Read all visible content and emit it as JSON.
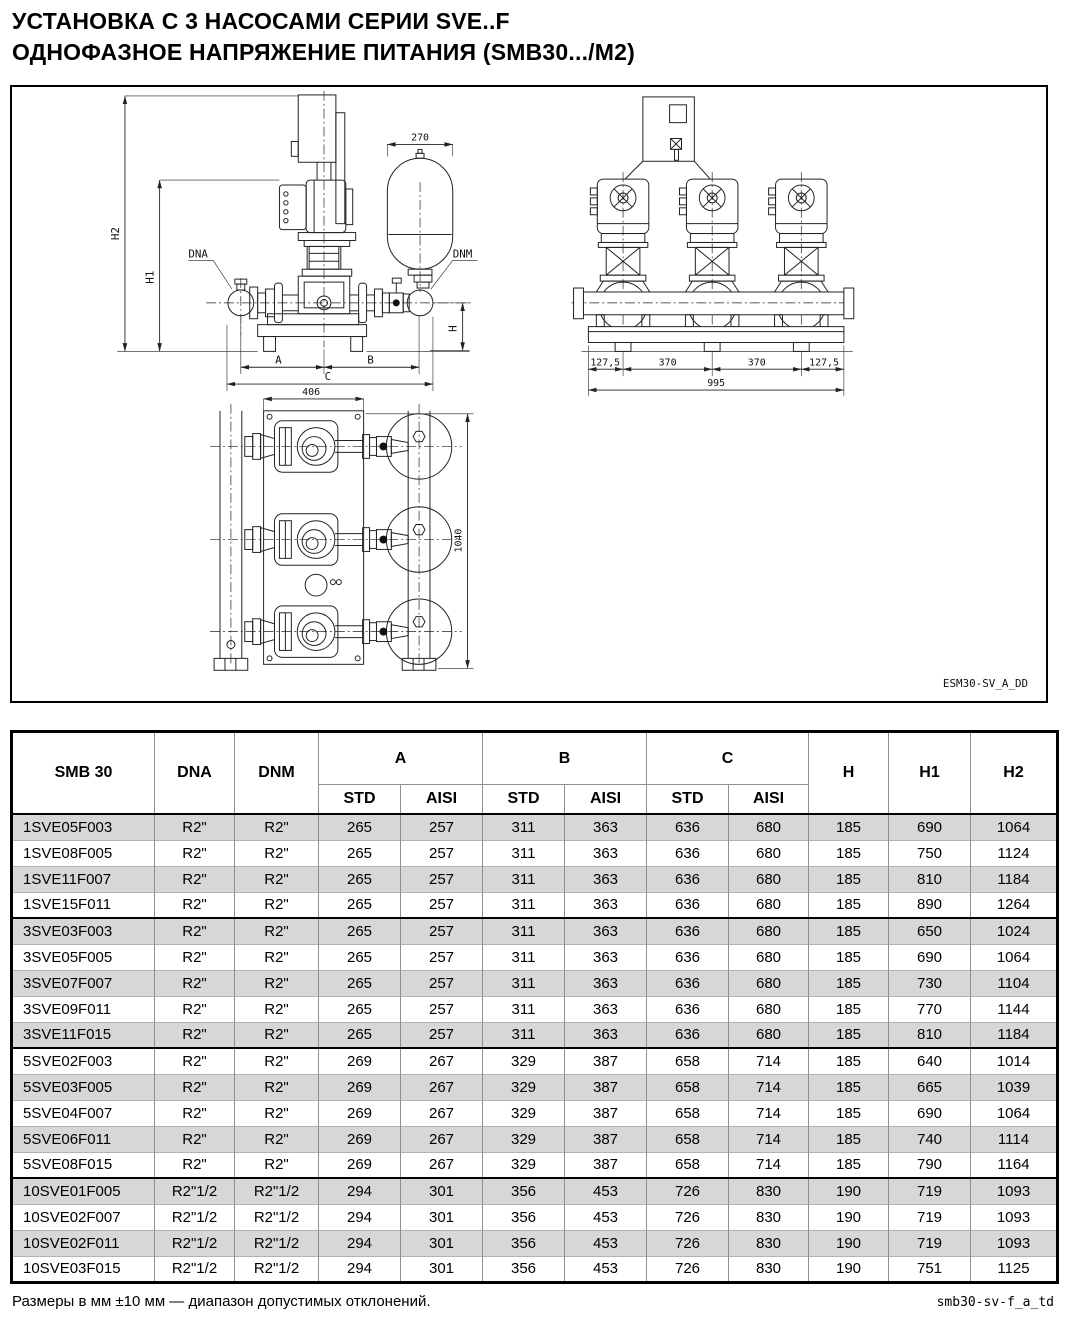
{
  "title": {
    "line1": "УСТАНОВКА С 3 НАСОСАМИ СЕРИИ SVE..F",
    "line2": "ОДНОФАЗНОЕ НАПРЯЖЕНИЕ ПИТАНИЯ (SMB30.../M2)"
  },
  "drawing": {
    "code": "ESM30-SV_A_DD",
    "front_view": {
      "h2": "H2",
      "h1": "H1",
      "h": "H",
      "dna": "DNA",
      "dnm": "DNM",
      "tank_width": "270",
      "a": "A",
      "b": "B",
      "c": "C"
    },
    "plan_view": {
      "width": "406",
      "depth": "1040"
    },
    "side_view": {
      "edge_left": "127,5",
      "pitch1": "370",
      "pitch2": "370",
      "edge_right": "127,5",
      "total": "995"
    }
  },
  "table": {
    "header": {
      "model": "SMB 30",
      "dna": "DNA",
      "dnm": "DNM",
      "a": "A",
      "b": "B",
      "c": "C",
      "std1": "STD",
      "aisi1": "AISI",
      "std2": "STD",
      "aisi2": "AISI",
      "std3": "STD",
      "aisi3": "AISI",
      "h": "H",
      "h1": "H1",
      "h2": "H2"
    },
    "groups": [
      {
        "rows": [
          [
            "1SVE05F003",
            "R2\"",
            "R2\"",
            "265",
            "257",
            "311",
            "363",
            "636",
            "680",
            "185",
            "690",
            "1064"
          ],
          [
            "1SVE08F005",
            "R2\"",
            "R2\"",
            "265",
            "257",
            "311",
            "363",
            "636",
            "680",
            "185",
            "750",
            "1124"
          ],
          [
            "1SVE11F007",
            "R2\"",
            "R2\"",
            "265",
            "257",
            "311",
            "363",
            "636",
            "680",
            "185",
            "810",
            "1184"
          ],
          [
            "1SVE15F011",
            "R2\"",
            "R2\"",
            "265",
            "257",
            "311",
            "363",
            "636",
            "680",
            "185",
            "890",
            "1264"
          ]
        ]
      },
      {
        "rows": [
          [
            "3SVE03F003",
            "R2\"",
            "R2\"",
            "265",
            "257",
            "311",
            "363",
            "636",
            "680",
            "185",
            "650",
            "1024"
          ],
          [
            "3SVE05F005",
            "R2\"",
            "R2\"",
            "265",
            "257",
            "311",
            "363",
            "636",
            "680",
            "185",
            "690",
            "1064"
          ],
          [
            "3SVE07F007",
            "R2\"",
            "R2\"",
            "265",
            "257",
            "311",
            "363",
            "636",
            "680",
            "185",
            "730",
            "1104"
          ],
          [
            "3SVE09F011",
            "R2\"",
            "R2\"",
            "265",
            "257",
            "311",
            "363",
            "636",
            "680",
            "185",
            "770",
            "1144"
          ],
          [
            "3SVE11F015",
            "R2\"",
            "R2\"",
            "265",
            "257",
            "311",
            "363",
            "636",
            "680",
            "185",
            "810",
            "1184"
          ]
        ]
      },
      {
        "rows": [
          [
            "5SVE02F003",
            "R2\"",
            "R2\"",
            "269",
            "267",
            "329",
            "387",
            "658",
            "714",
            "185",
            "640",
            "1014"
          ],
          [
            "5SVE03F005",
            "R2\"",
            "R2\"",
            "269",
            "267",
            "329",
            "387",
            "658",
            "714",
            "185",
            "665",
            "1039"
          ],
          [
            "5SVE04F007",
            "R2\"",
            "R2\"",
            "269",
            "267",
            "329",
            "387",
            "658",
            "714",
            "185",
            "690",
            "1064"
          ],
          [
            "5SVE06F011",
            "R2\"",
            "R2\"",
            "269",
            "267",
            "329",
            "387",
            "658",
            "714",
            "185",
            "740",
            "1114"
          ],
          [
            "5SVE08F015",
            "R2\"",
            "R2\"",
            "269",
            "267",
            "329",
            "387",
            "658",
            "714",
            "185",
            "790",
            "1164"
          ]
        ]
      },
      {
        "rows": [
          [
            "10SVE01F005",
            "R2\"1/2",
            "R2\"1/2",
            "294",
            "301",
            "356",
            "453",
            "726",
            "830",
            "190",
            "719",
            "1093"
          ],
          [
            "10SVE02F007",
            "R2\"1/2",
            "R2\"1/2",
            "294",
            "301",
            "356",
            "453",
            "726",
            "830",
            "190",
            "719",
            "1093"
          ],
          [
            "10SVE02F011",
            "R2\"1/2",
            "R2\"1/2",
            "294",
            "301",
            "356",
            "453",
            "726",
            "830",
            "190",
            "719",
            "1093"
          ],
          [
            "10SVE03F015",
            "R2\"1/2",
            "R2\"1/2",
            "294",
            "301",
            "356",
            "453",
            "726",
            "830",
            "190",
            "751",
            "1125"
          ]
        ]
      }
    ]
  },
  "footer": {
    "note": "Размеры в мм ±10 мм — диапазон допустимых отклонений.",
    "code": "smb30-sv-f_a_td"
  }
}
